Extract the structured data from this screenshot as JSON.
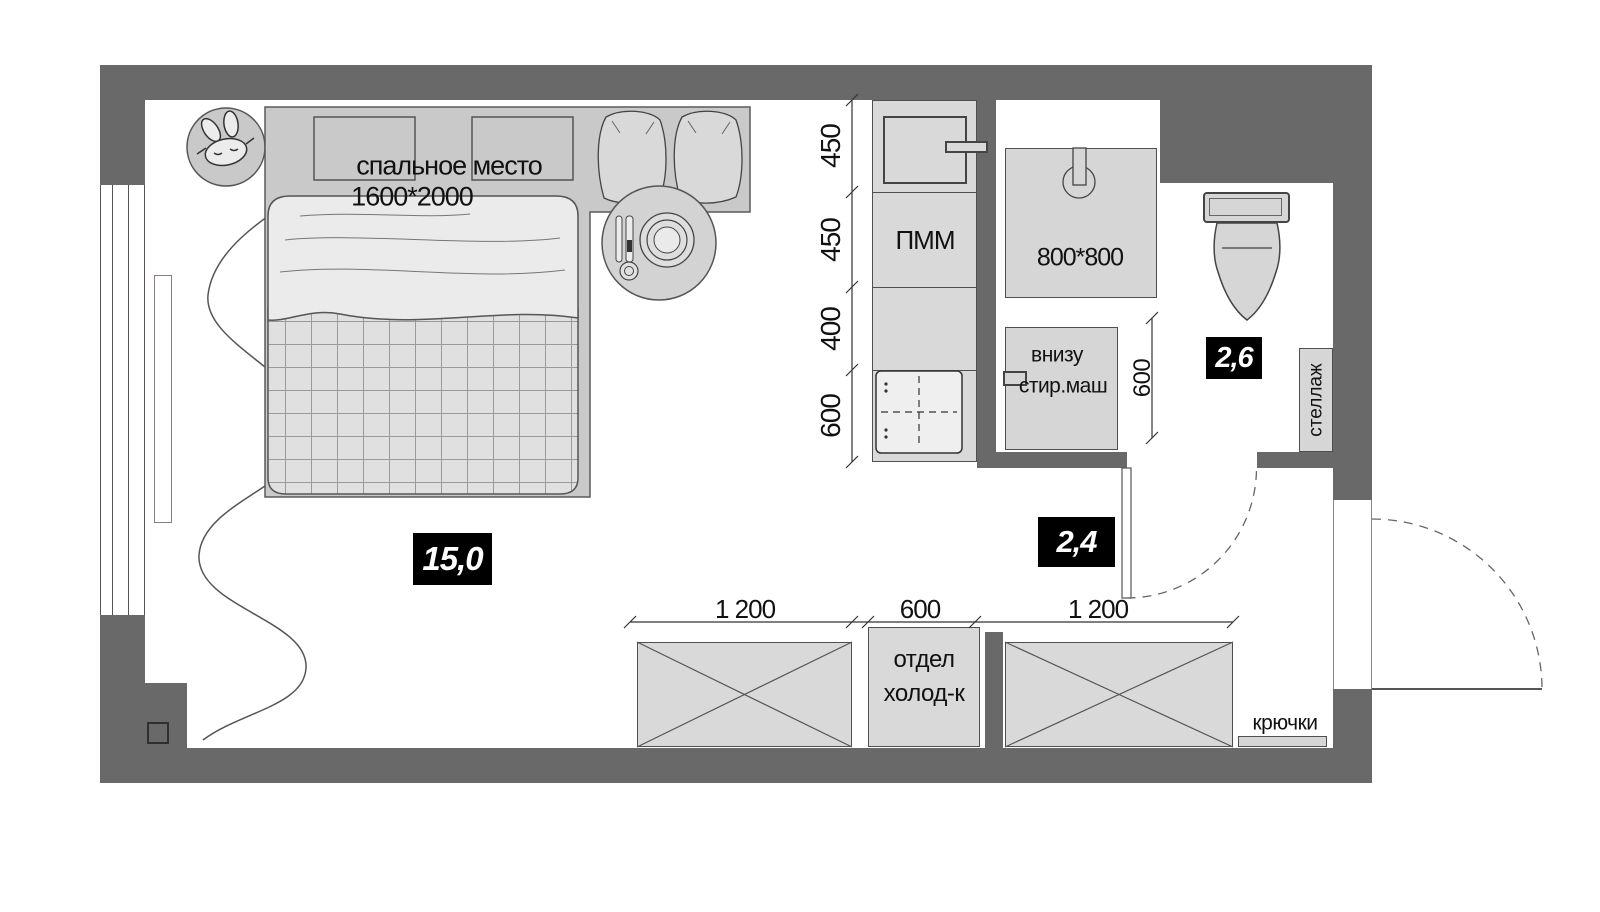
{
  "main_room": {
    "area_badge": "15,0"
  },
  "bedroom": {
    "sleeping_place_label": "спальное место",
    "sleeping_place_size": "1600*2000"
  },
  "kitchen": {
    "dishwasher_label": "ПММ",
    "section_dims": [
      "450",
      "450",
      "400",
      "600"
    ]
  },
  "bathroom": {
    "area_badge": "2,6",
    "shower_size_label": "800*800",
    "washer_label_line1": "внизу",
    "washer_label_line2": "стир.маш",
    "washer_depth_dim": "600",
    "shelf_label": "стеллаж"
  },
  "hallway": {
    "area_badge": "2,4",
    "storage_dims": [
      "1 200",
      "600",
      "1 200"
    ],
    "fridge_label_line1": "отдел",
    "fridge_label_line2": "холод-к",
    "hooks_label": "крючки"
  },
  "icons": {
    "sleep_mask": "sleep-mask-icon",
    "shower_head": "shower-head-icon",
    "cooktop": "cooktop-icon",
    "sink": "sink-icon",
    "toilet": "toilet-icon",
    "door_swing": "door-swing-arc"
  },
  "colors": {
    "wall": "#696969",
    "furniture_fill": "#d8d8d8",
    "bed_fill": "#ebebeb",
    "badge_bg": "#000000",
    "badge_text": "#ffffff",
    "line": "#444444",
    "floor": "#ffffff"
  }
}
